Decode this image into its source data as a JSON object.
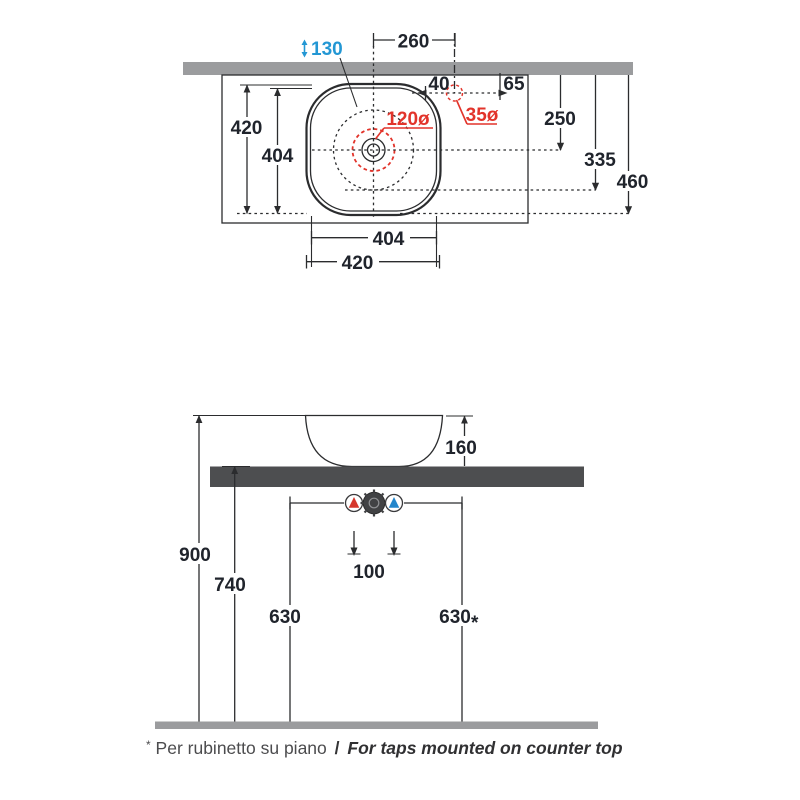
{
  "colors": {
    "accent_red": "#e2342b",
    "accent_blue": "#2397d4",
    "counter_plan_gray": "#9b9c9e",
    "counter_side_gray": "#4d4e50",
    "floor_gray": "#9b9c9e",
    "ink": "#20242c"
  },
  "top_view": {
    "center_to_hole": "260",
    "basin_inner_height": "130",
    "hole_offset": "40",
    "hole_to_edge": "65",
    "depth_1": "250",
    "depth_2": "335",
    "depth_3": "460",
    "side_outer": "420",
    "side_inner": "404",
    "bottom_inner": "404",
    "bottom_outer": "420",
    "drain_dia": "120ø",
    "tap_hole_dia": "35ø"
  },
  "side_view": {
    "basin_height": "160",
    "counter_height": "900",
    "under_counter": "740",
    "supply_left": "630",
    "supply_right": "630",
    "star": "*",
    "tap_spacing": "100"
  },
  "footnote": {
    "marker": "*",
    "text_it": "Per rubinetto su piano",
    "sep": "/",
    "text_en": "For taps mounted on counter top"
  }
}
